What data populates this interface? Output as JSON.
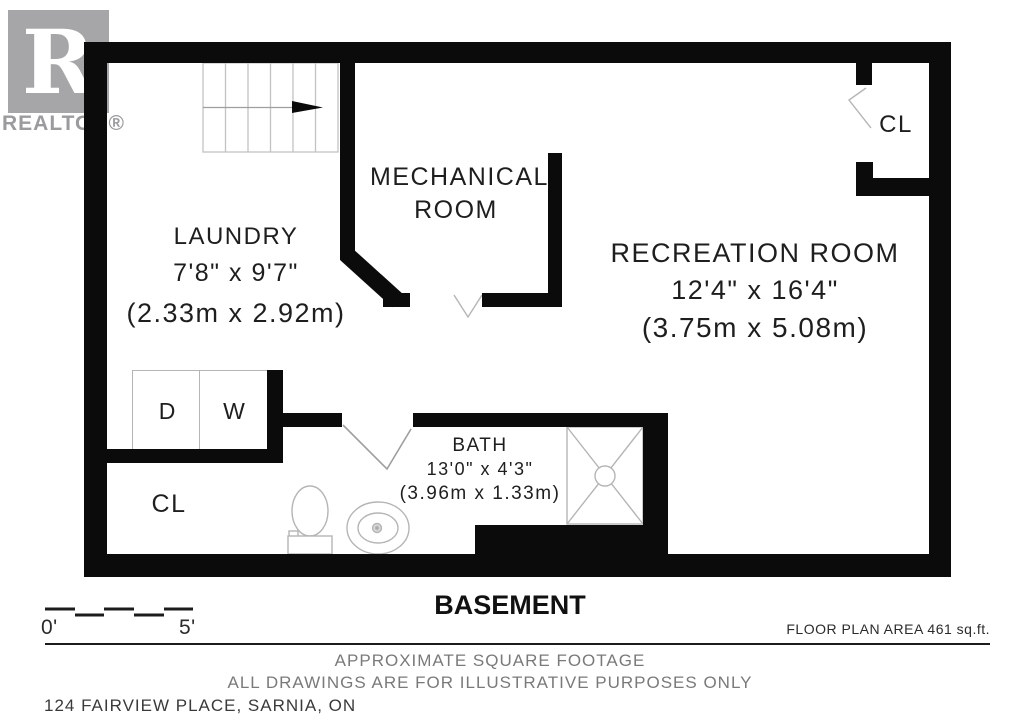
{
  "logo": {
    "letter": "R",
    "wordmark": "REALTOR®"
  },
  "plan": {
    "laundry": {
      "name": "LAUNDRY",
      "size_imperial": "7'8\" x 9'7\"",
      "size_metric": "(2.33m x 2.92m)"
    },
    "mechanical": {
      "name_line_1": "MECHANICAL",
      "name_line_2": "ROOM"
    },
    "recreation": {
      "name": "RECREATION ROOM",
      "size_imperial": "12'4\" x 16'4\"",
      "size_metric": "(3.75m x 5.08m)"
    },
    "bath": {
      "name": "BATH",
      "size_imperial": "13'0\" x 4'3\"",
      "size_metric": "(3.96m x 1.33m)"
    },
    "closet_upper": {
      "label": "CL"
    },
    "closet_lower": {
      "label": "CL"
    },
    "dryer_label": "D",
    "washer_label": "W"
  },
  "title": {
    "text": "BASEMENT"
  },
  "scale_bar": {
    "start_label": "0'",
    "end_label": "5'"
  },
  "notes": {
    "area": "FLOOR PLAN AREA 461 sq.ft.",
    "line_1": "APPROXIMATE SQUARE FOOTAGE",
    "line_2": "ALL DRAWINGS ARE FOR ILLUSTRATIVE PURPOSES ONLY",
    "address": "124 FAIRVIEW PLACE, SARNIA, ON"
  },
  "colors": {
    "wall": "#0b0b0b",
    "fixture_line": "#b5b5b5",
    "logo_gray": "#a6a6a9",
    "footer_gray": "#7a7a7a"
  }
}
